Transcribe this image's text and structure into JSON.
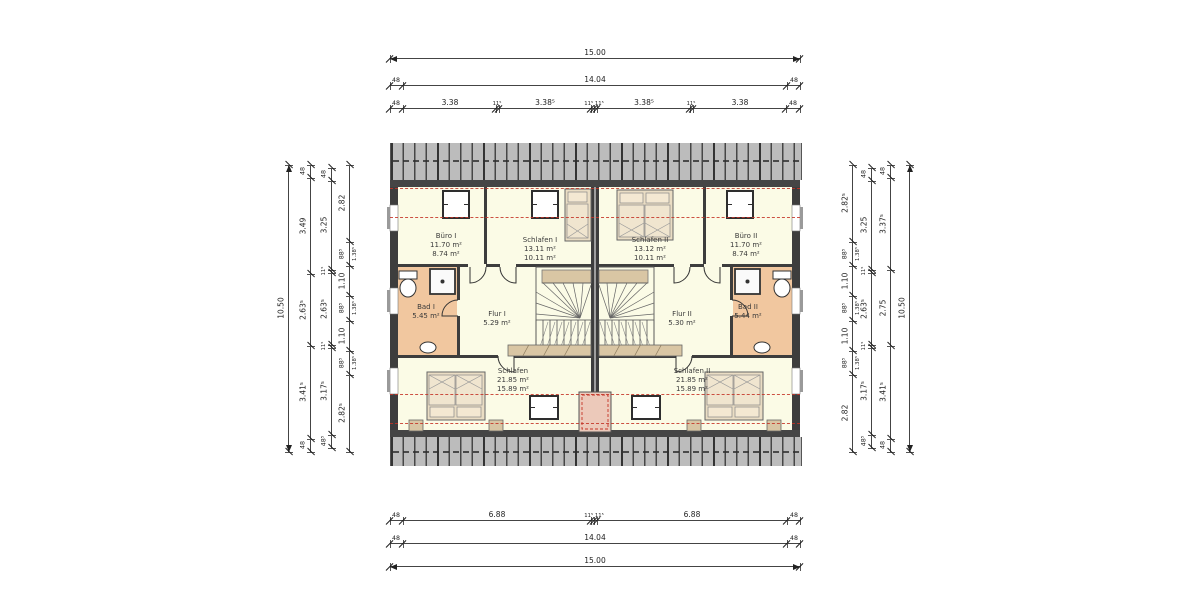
{
  "colors": {
    "room_fill": "#fbfbe6",
    "bath_fill": "#f1c79f",
    "wall": "#3d3d3d",
    "roof_gray": "#bcbcbc",
    "eaves": "#454545",
    "red_dash": "#c43326",
    "furniture_tan": "#d9c6a4",
    "bed_fill": "#eaddc4",
    "pillow_fill": "#f4e8d2",
    "dim_line": "#444444"
  },
  "rooms": [
    {
      "id": "buero-1",
      "name": "Büro I",
      "area_floor": "11.70 m²",
      "area_living": "8.74 m²"
    },
    {
      "id": "schlafen-1",
      "name": "Schlafen I",
      "area_floor": "13.11 m²",
      "area_living": "10.11 m²"
    },
    {
      "id": "schlafen-2",
      "name": "Schlafen II",
      "area_floor": "13.12 m²",
      "area_living": "10.11 m²"
    },
    {
      "id": "buero-2",
      "name": "Büro II",
      "area_floor": "11.70 m²",
      "area_living": "8.74 m²"
    },
    {
      "id": "bad-1",
      "name": "Bad I",
      "area_floor": "5.45 m²"
    },
    {
      "id": "flur-1",
      "name": "Flur I",
      "area_floor": "5.29 m²"
    },
    {
      "id": "flur-2",
      "name": "Flur II",
      "area_floor": "5.30 m²"
    },
    {
      "id": "bad-2",
      "name": "Bad II",
      "area_floor": "5.44 m²"
    },
    {
      "id": "schlafen-bottom-left",
      "name": "Schlafen",
      "area_floor": "21.85 m²",
      "area_living": "15.89 m²"
    },
    {
      "id": "schlafen-bottom-right",
      "name": "Schlafen II",
      "area_floor": "21.85 m²",
      "area_living": "15.89 m²"
    }
  ],
  "dim_chains": [
    {
      "id": "top-total",
      "dir": "h",
      "y": 58,
      "x1": 390,
      "x2": 800,
      "arrows": true,
      "ticks": [
        390,
        800
      ],
      "parts": [
        {
          "label": "15.00",
          "at": 595
        }
      ]
    },
    {
      "id": "top-shell",
      "dir": "h",
      "y": 85,
      "x1": 390,
      "x2": 800,
      "ticks": [
        390,
        403,
        787,
        800
      ],
      "parts": [
        {
          "label": "48",
          "at": 396,
          "size": "s"
        },
        {
          "label": "14.04",
          "at": 595
        },
        {
          "label": "48",
          "at": 794,
          "size": "s"
        }
      ]
    },
    {
      "id": "top-rooms",
      "dir": "h",
      "y": 108,
      "x1": 390,
      "x2": 800,
      "ticks": [
        390,
        403,
        496,
        499,
        591,
        594,
        597,
        690,
        693,
        786,
        800
      ],
      "parts": [
        {
          "label": "48",
          "at": 396,
          "size": "s"
        },
        {
          "label": "3.38",
          "at": 450
        },
        {
          "label": "11⁵",
          "at": 497,
          "size": "t"
        },
        {
          "label": "3.38⁵",
          "at": 545
        },
        {
          "label": "11⁵ 11⁵",
          "at": 594,
          "size": "t"
        },
        {
          "label": "3.38⁵",
          "at": 644
        },
        {
          "label": "11⁵",
          "at": 691,
          "size": "t"
        },
        {
          "label": "3.38",
          "at": 740
        },
        {
          "label": "48",
          "at": 793,
          "size": "s"
        }
      ]
    },
    {
      "id": "bottom-rooms",
      "dir": "h",
      "y": 520,
      "x1": 390,
      "x2": 800,
      "ticks": [
        390,
        403,
        591,
        594,
        597,
        787,
        800
      ],
      "parts": [
        {
          "label": "48",
          "at": 396,
          "size": "s"
        },
        {
          "label": "6.88",
          "at": 497
        },
        {
          "label": "11⁵ 11⁵",
          "at": 594,
          "size": "t"
        },
        {
          "label": "6.88",
          "at": 692
        },
        {
          "label": "48",
          "at": 794,
          "size": "s"
        }
      ]
    },
    {
      "id": "bottom-shell",
      "dir": "h",
      "y": 543,
      "x1": 390,
      "x2": 800,
      "ticks": [
        390,
        403,
        787,
        800
      ],
      "parts": [
        {
          "label": "48",
          "at": 396,
          "size": "s"
        },
        {
          "label": "14.04",
          "at": 595
        },
        {
          "label": "48",
          "at": 794,
          "size": "s"
        }
      ]
    },
    {
      "id": "bottom-total",
      "dir": "h",
      "y": 566,
      "x1": 390,
      "x2": 800,
      "arrows": true,
      "ticks": [
        390,
        800
      ],
      "parts": [
        {
          "label": "15.00",
          "at": 595
        }
      ]
    },
    {
      "id": "left-total",
      "dir": "v",
      "x": 288,
      "y1": 165,
      "y2": 452,
      "arrows": true,
      "ticks": [
        165,
        452
      ],
      "parts": [
        {
          "label": "10.50",
          "at": 308
        }
      ]
    },
    {
      "id": "left-rooms",
      "dir": "v",
      "x": 310,
      "y1": 165,
      "y2": 452,
      "ticks": [
        165,
        178,
        274,
        346,
        439,
        452
      ],
      "parts": [
        {
          "label": "48",
          "at": 171,
          "size": "s"
        },
        {
          "label": "3.49",
          "at": 226
        },
        {
          "label": "2.63⁵",
          "at": 310
        },
        {
          "label": "3.41⁵",
          "at": 392
        },
        {
          "label": "48",
          "at": 445,
          "size": "s"
        }
      ]
    },
    {
      "id": "left-inner",
      "dir": "v",
      "x": 331,
      "y1": 168,
      "y2": 448,
      "ticks": [
        168,
        181,
        270,
        273,
        345,
        348,
        435,
        448
      ],
      "parts": [
        {
          "label": "48",
          "at": 174,
          "size": "s"
        },
        {
          "label": "3.25",
          "at": 225
        },
        {
          "label": "11⁵",
          "at": 271,
          "size": "t"
        },
        {
          "label": "2.63⁵",
          "at": 309
        },
        {
          "label": "11⁵",
          "at": 346,
          "size": "t"
        },
        {
          "label": "3.17⁵",
          "at": 391
        },
        {
          "label": "48⁵",
          "at": 441,
          "size": "s"
        }
      ]
    },
    {
      "id": "left-detail",
      "dir": "v",
      "x": 349,
      "y1": 165,
      "y2": 452,
      "ticks": [
        165,
        242,
        266,
        296,
        321,
        351,
        375,
        452
      ],
      "parts": [
        {
          "label": "2.82",
          "at": 203
        },
        {
          "label": "88⁵",
          "at": 254,
          "size": "s",
          "label2": "1.38⁵"
        },
        {
          "label": "1.10",
          "at": 281
        },
        {
          "label": "88⁵",
          "at": 308,
          "size": "s",
          "label2": "1.38⁵"
        },
        {
          "label": "1.10",
          "at": 336
        },
        {
          "label": "88⁵",
          "at": 363,
          "size": "s",
          "label2": "1.38⁵"
        },
        {
          "label": "2.82⁵",
          "at": 413
        }
      ]
    },
    {
      "id": "right-detail",
      "dir": "v",
      "x": 852,
      "y1": 165,
      "y2": 452,
      "ticks": [
        165,
        242,
        266,
        296,
        321,
        351,
        375,
        452
      ],
      "parts": [
        {
          "label": "2.82⁵",
          "at": 203
        },
        {
          "label": "88⁵",
          "at": 254,
          "size": "s",
          "label2": "1.38⁵"
        },
        {
          "label": "1.10",
          "at": 281
        },
        {
          "label": "88⁵",
          "at": 308,
          "size": "s",
          "label2": "1.38⁵"
        },
        {
          "label": "1.10",
          "at": 336
        },
        {
          "label": "88⁵",
          "at": 363,
          "size": "s",
          "label2": "1.38⁵"
        },
        {
          "label": "2.82",
          "at": 413
        }
      ]
    },
    {
      "id": "right-inner",
      "dir": "v",
      "x": 871,
      "y1": 168,
      "y2": 448,
      "ticks": [
        168,
        181,
        270,
        273,
        345,
        348,
        435,
        448
      ],
      "parts": [
        {
          "label": "48",
          "at": 174,
          "size": "s"
        },
        {
          "label": "3.25",
          "at": 225
        },
        {
          "label": "11⁵",
          "at": 271,
          "size": "t"
        },
        {
          "label": "2.63⁵",
          "at": 309
        },
        {
          "label": "11⁵",
          "at": 346,
          "size": "t"
        },
        {
          "label": "3.17⁵",
          "at": 391
        },
        {
          "label": "48⁵",
          "at": 441,
          "size": "s"
        }
      ]
    },
    {
      "id": "right-rooms",
      "dir": "v",
      "x": 890,
      "y1": 165,
      "y2": 452,
      "ticks": [
        165,
        178,
        270,
        346,
        439,
        452
      ],
      "parts": [
        {
          "label": "48",
          "at": 171,
          "size": "s"
        },
        {
          "label": "3.37⁵",
          "at": 224
        },
        {
          "label": "2.75",
          "at": 308
        },
        {
          "label": "3.41⁵",
          "at": 392
        },
        {
          "label": "48",
          "at": 445,
          "size": "s"
        }
      ]
    },
    {
      "id": "right-total",
      "dir": "v",
      "x": 909,
      "y1": 165,
      "y2": 452,
      "arrows": true,
      "ticks": [
        165,
        452
      ],
      "parts": [
        {
          "label": "10.50",
          "at": 308
        }
      ]
    }
  ],
  "geometry": {
    "red_lines_y": [
      188,
      216.5,
      393.5,
      422.5
    ],
    "walls": [
      [
        390,
        187,
        8,
        243
      ],
      [
        792,
        187,
        8,
        243
      ],
      [
        591,
        187,
        8,
        243
      ],
      [
        484,
        187,
        3,
        77
      ],
      [
        703,
        187,
        3,
        77
      ],
      [
        398,
        264,
        70,
        3
      ],
      [
        486,
        264,
        14,
        3
      ],
      [
        516,
        264,
        75,
        3
      ],
      [
        599,
        264,
        75,
        3
      ],
      [
        690,
        264,
        14,
        3
      ],
      [
        722,
        264,
        70,
        3
      ],
      [
        457,
        267,
        3,
        33
      ],
      [
        457,
        316,
        3,
        39
      ],
      [
        730,
        267,
        3,
        33
      ],
      [
        730,
        316,
        3,
        39
      ],
      [
        398,
        355,
        100,
        3
      ],
      [
        514,
        355,
        77,
        3
      ],
      [
        599,
        355,
        77,
        3
      ],
      [
        692,
        355,
        100,
        3
      ]
    ],
    "party_gap": [
      594.5,
      187,
      1,
      243
    ],
    "gable_windows": [
      [
        390,
        205,
        8,
        26
      ],
      [
        390,
        288,
        8,
        26
      ],
      [
        390,
        368,
        8,
        26
      ],
      [
        792,
        205,
        8,
        26
      ],
      [
        792,
        288,
        8,
        26
      ],
      [
        792,
        368,
        8,
        26
      ]
    ],
    "sills": [
      [
        387,
        207,
        3,
        22
      ],
      [
        387,
        290,
        3,
        22
      ],
      [
        387,
        370,
        3,
        22
      ],
      [
        800,
        207,
        3,
        22
      ],
      [
        800,
        290,
        3,
        22
      ],
      [
        800,
        370,
        3,
        22
      ]
    ],
    "furniture": [
      {
        "type": "window",
        "x": 443,
        "y": 191,
        "w": 26,
        "h": 27
      },
      {
        "type": "window",
        "x": 532,
        "y": 191,
        "w": 26,
        "h": 27
      },
      {
        "type": "window",
        "x": 727,
        "y": 191,
        "w": 26,
        "h": 27
      },
      {
        "type": "window",
        "x": 530,
        "y": 396,
        "w": 28,
        "h": 23
      },
      {
        "type": "window",
        "x": 632,
        "y": 396,
        "w": 28,
        "h": 23
      },
      {
        "type": "bed",
        "x": 565,
        "y": 189,
        "w": 26,
        "h": 52,
        "double": false,
        "pillow": "top"
      },
      {
        "type": "bed",
        "x": 617,
        "y": 190,
        "w": 56,
        "h": 50,
        "double": true,
        "pillow": "top"
      },
      {
        "type": "bed",
        "x": 427,
        "y": 372,
        "w": 58,
        "h": 48,
        "double": true,
        "pillow": "bottom"
      },
      {
        "type": "bed",
        "x": 705,
        "y": 372,
        "w": 58,
        "h": 48,
        "double": true,
        "pillow": "bottom"
      },
      {
        "type": "nightstand",
        "x": 409,
        "y": 420,
        "w": 14,
        "h": 11
      },
      {
        "type": "nightstand",
        "x": 489,
        "y": 420,
        "w": 14,
        "h": 11
      },
      {
        "type": "nightstand",
        "x": 687,
        "y": 420,
        "w": 14,
        "h": 11
      },
      {
        "type": "nightstand",
        "x": 767,
        "y": 420,
        "w": 14,
        "h": 11
      },
      {
        "type": "sideboard",
        "x": 508,
        "y": 345,
        "w": 83,
        "h": 11
      },
      {
        "type": "sideboard",
        "x": 599,
        "y": 345,
        "w": 83,
        "h": 11
      },
      {
        "type": "wc",
        "x": 399,
        "y": 271,
        "w": 18,
        "h": 26
      },
      {
        "type": "wc",
        "x": 773,
        "y": 271,
        "w": 18,
        "h": 26
      },
      {
        "type": "shower",
        "x": 430,
        "y": 269,
        "w": 25,
        "h": 25
      },
      {
        "type": "shower",
        "x": 735,
        "y": 269,
        "w": 25,
        "h": 25
      },
      {
        "type": "basin",
        "x": 420,
        "y": 342,
        "w": 16,
        "h": 11
      },
      {
        "type": "basin",
        "x": 754,
        "y": 342,
        "w": 16,
        "h": 11
      },
      {
        "type": "chimney",
        "x": 579,
        "y": 392,
        "w": 32,
        "h": 40
      },
      {
        "type": "door",
        "d": "M486,267 A16,16 0 0 1 470,283 L470,267"
      },
      {
        "type": "door",
        "d": "M500,267 A16,16 0 0 0 516,283 L516,267"
      },
      {
        "type": "door",
        "d": "M458,300 A16,16 0 0 0 442,316 L458,316"
      },
      {
        "type": "door",
        "d": "M498,356 A16,16 0 0 0 514,372 L514,356"
      },
      {
        "type": "door",
        "d": "M704,267 A16,16 0 0 0 720,283 L720,267"
      },
      {
        "type": "door",
        "d": "M690,267 A16,16 0 0 1 674,283 L674,267"
      },
      {
        "type": "door",
        "d": "M732,300 A16,16 0 0 1 748,316 L732,316"
      },
      {
        "type": "door",
        "d": "M692,356 A16,16 0 0 1 676,372 L676,356"
      }
    ],
    "stairs": [
      {
        "x": 536,
        "y": 267,
        "w": 55,
        "h": 88,
        "mirror": false
      },
      {
        "x": 536,
        "y": 267,
        "w": 55,
        "h": 88,
        "mirror": true
      }
    ]
  }
}
